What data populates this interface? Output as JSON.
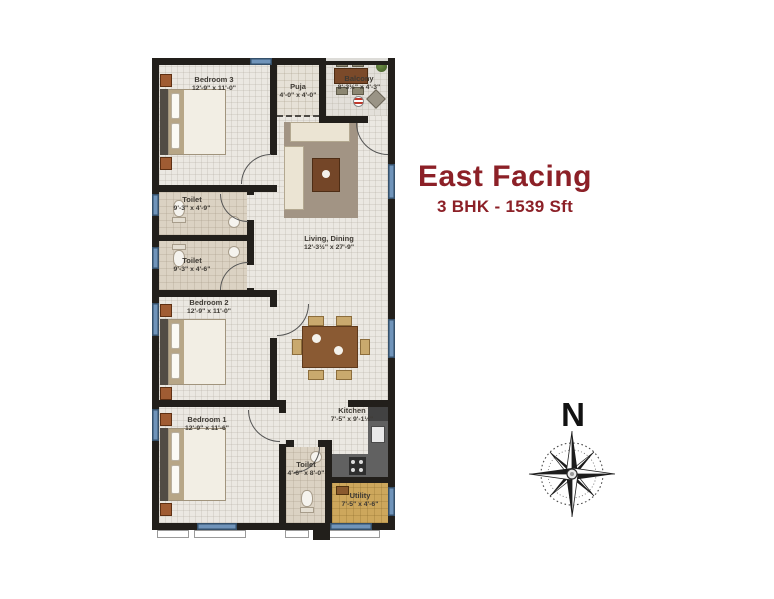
{
  "header": {
    "title": "East Facing",
    "subtitle": "3 BHK - 1539 Sft"
  },
  "compass": {
    "label": "N"
  },
  "rooms": {
    "bedroom3": {
      "name": "Bedroom 3",
      "dims": "12'-9\" x 11'-0\""
    },
    "puja": {
      "name": "Puja",
      "dims": "4'-0\" x 4'-0\""
    },
    "balcony": {
      "name": "Balcony",
      "dims": "8'-3½\" x 4'-3\""
    },
    "living": {
      "name": "Living, Dining",
      "dims": "12'-3½\" x 27'-9\""
    },
    "toilet_a": {
      "name": "Toilet",
      "dims": "9'-3\" x 4'-9\""
    },
    "toilet_b": {
      "name": "Toilet",
      "dims": "9'-3\" x 4'-6\""
    },
    "bedroom2": {
      "name": "Bedroom 2",
      "dims": "12'-9\" x 11'-0\""
    },
    "bedroom1": {
      "name": "Bedroom 1",
      "dims": "12'-9\" x 11'-6\""
    },
    "toilet_c": {
      "name": "Toilet",
      "dims": "4'-6\" x 8'-0\""
    },
    "kitchen": {
      "name": "Kitchen",
      "dims": "7'-5\" x 9'-1½\""
    },
    "utility": {
      "name": "Utility",
      "dims": "7'-5\" x 4'-6\""
    }
  },
  "colors": {
    "accent_red": "#8C2027",
    "wall": "#221F1B",
    "window_blue": "#7094BA",
    "floor": "#EBE8E2",
    "toilet_floor": "#DBD2C3",
    "utility_floor": "#CDA75C"
  }
}
